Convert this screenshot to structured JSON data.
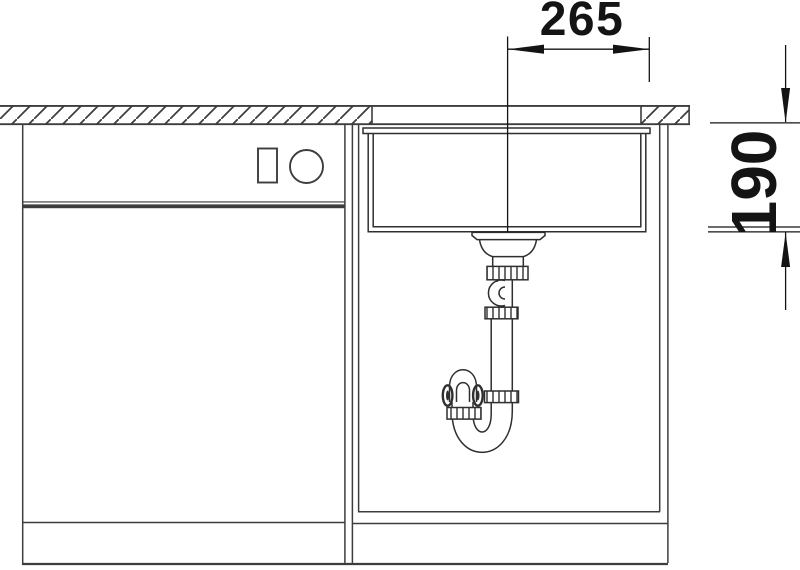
{
  "dimensions": {
    "horizontal": {
      "label": "265"
    },
    "vertical": {
      "label": "190"
    }
  },
  "colors": {
    "background": "#ffffff",
    "furniture_line": "#3d3d3d",
    "sink_line": "#2f2f2f",
    "dimension": "#141414"
  }
}
